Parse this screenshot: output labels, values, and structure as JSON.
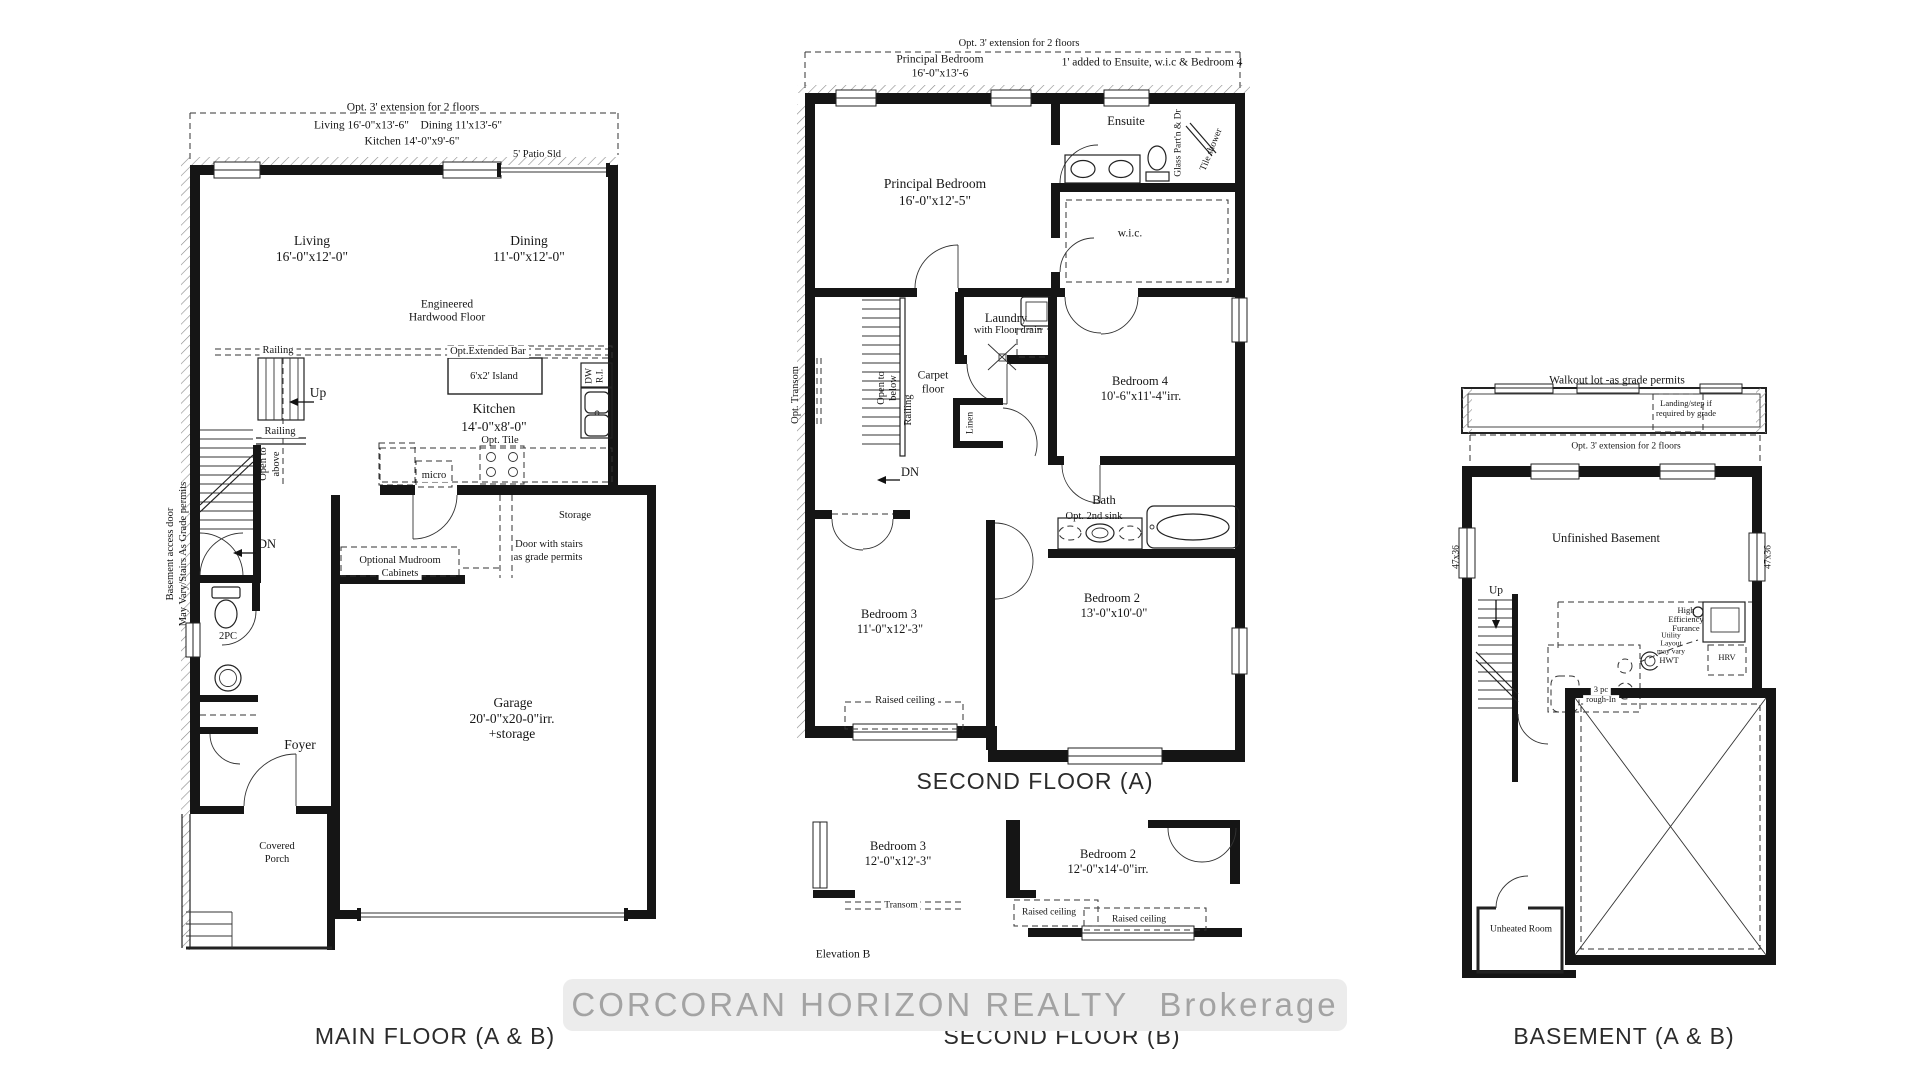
{
  "watermark": {
    "brand": "CORCORAN HORIZON REALTY",
    "suffix": "Brokerage"
  },
  "m": {
    "title": "MAIN FLOOR (A & B)",
    "ext_note": "Opt. 3' extension for 2 floors",
    "ext_dims1": "Living 16'-0\"x13'-6\"    Dining 11'x13'-6\"",
    "ext_dims2": "Kitchen 14'-0\"x9'-6\"",
    "patio": "5' Patio Sld",
    "living": "Living",
    "living_dims": "16'-0\"x12'-0\"",
    "dining": "Dining",
    "dining_dims": "11'-0\"x12'-0\"",
    "floor1": "Engineered",
    "floor2": "Hardwood Floor",
    "railing1": "Railing",
    "railing2": "Railing",
    "bar": "Opt.Extended Bar",
    "island": "6'x2' Island",
    "up": "Up",
    "open1": "Open to",
    "open2": "above",
    "kitchen": "Kitchen",
    "kitchen_dims": "14'-0\"x8'-0\"",
    "tile": "Opt. Tile",
    "dw": "DW",
    "ri": "R.I.",
    "micro": "micro",
    "storage": "Storage",
    "door1": "Door with stairs",
    "door2": "as grade permits",
    "mud1": "Optional Mudroom",
    "mud2": "Cabinets",
    "acc1": "Basement access door",
    "acc2": "May Vary/Stairs As Grade permits",
    "dn": "DN",
    "wc": "2PC",
    "garage": "Garage",
    "garage_dims": "20'-0\"x20-0\"irr.",
    "garage_note": "+storage",
    "foyer": "Foyer",
    "porch1": "Covered",
    "porch2": "Porch"
  },
  "a": {
    "title": "SECOND FLOOR (A)",
    "ext_note": "Opt. 3' extension for 2 floors",
    "ext_pb1": "Principal Bedroom",
    "ext_pb2": "16'-0\"x13'-6",
    "added": "1' added to Ensuite, w.i.c & Bedroom 4",
    "pb": "Principal Bedroom",
    "pb_dims": "16'-0\"x12'-5\"",
    "ensuite": "Ensuite",
    "glass": "Glass Part'n & Dr",
    "tile_shower": "Tile shower",
    "wic": "w.i.c.",
    "laundry1": "Laundry",
    "laundry2": "with Floor drain",
    "carpet1": "Carpet",
    "carpet2": "floor",
    "open1": "Open to",
    "open2": "below",
    "railing": "Railing",
    "transom": "Opt. Transom",
    "b4": "Bedroom 4",
    "b4_dims": "10'-6\"x11'-4\"irr.",
    "dn": "DN",
    "linen": "Linen",
    "bath": "Bath",
    "sink2": "Opt. 2nd sink",
    "b2": "Bedroom 2",
    "b2_dims": "13'-0\"x10'-0\"",
    "b3": "Bedroom 3",
    "b3_dims": "11'-0\"x12'-3\"",
    "raised": "Raised ceiling"
  },
  "b": {
    "title": "SECOND FLOOR (B)",
    "b3": "Bedroom 3",
    "b3_dims": "12'-0\"x12'-3\"",
    "b2": "Bedroom 2",
    "b2_dims": "12'-0\"x14'-0\"irr.",
    "transom": "Transom",
    "raised1": "Raised ceiling",
    "raised2": "Raised ceiling",
    "elevation": "Elevation B"
  },
  "bs": {
    "title": "BASEMENT (A & B)",
    "walkout": "Walkout lot -as grade permits",
    "landing1": "Landing/step if",
    "landing2": "required by grade",
    "ext_note": "Opt. 3' extension for 2 floors",
    "unfinished": "Unfinished Basement",
    "up": "Up",
    "size_l": "47x36",
    "size_r": "47x36",
    "furnace1": "High",
    "furnace2": "Efficiency",
    "furnace3": "Furance",
    "util1": "Utility",
    "util2": "Layout",
    "util3": "may vary",
    "hwt": "HWT",
    "hrv": "HRV",
    "rough1": "3 pc",
    "rough2": "rough-In",
    "unheated": "Unheated Room"
  }
}
